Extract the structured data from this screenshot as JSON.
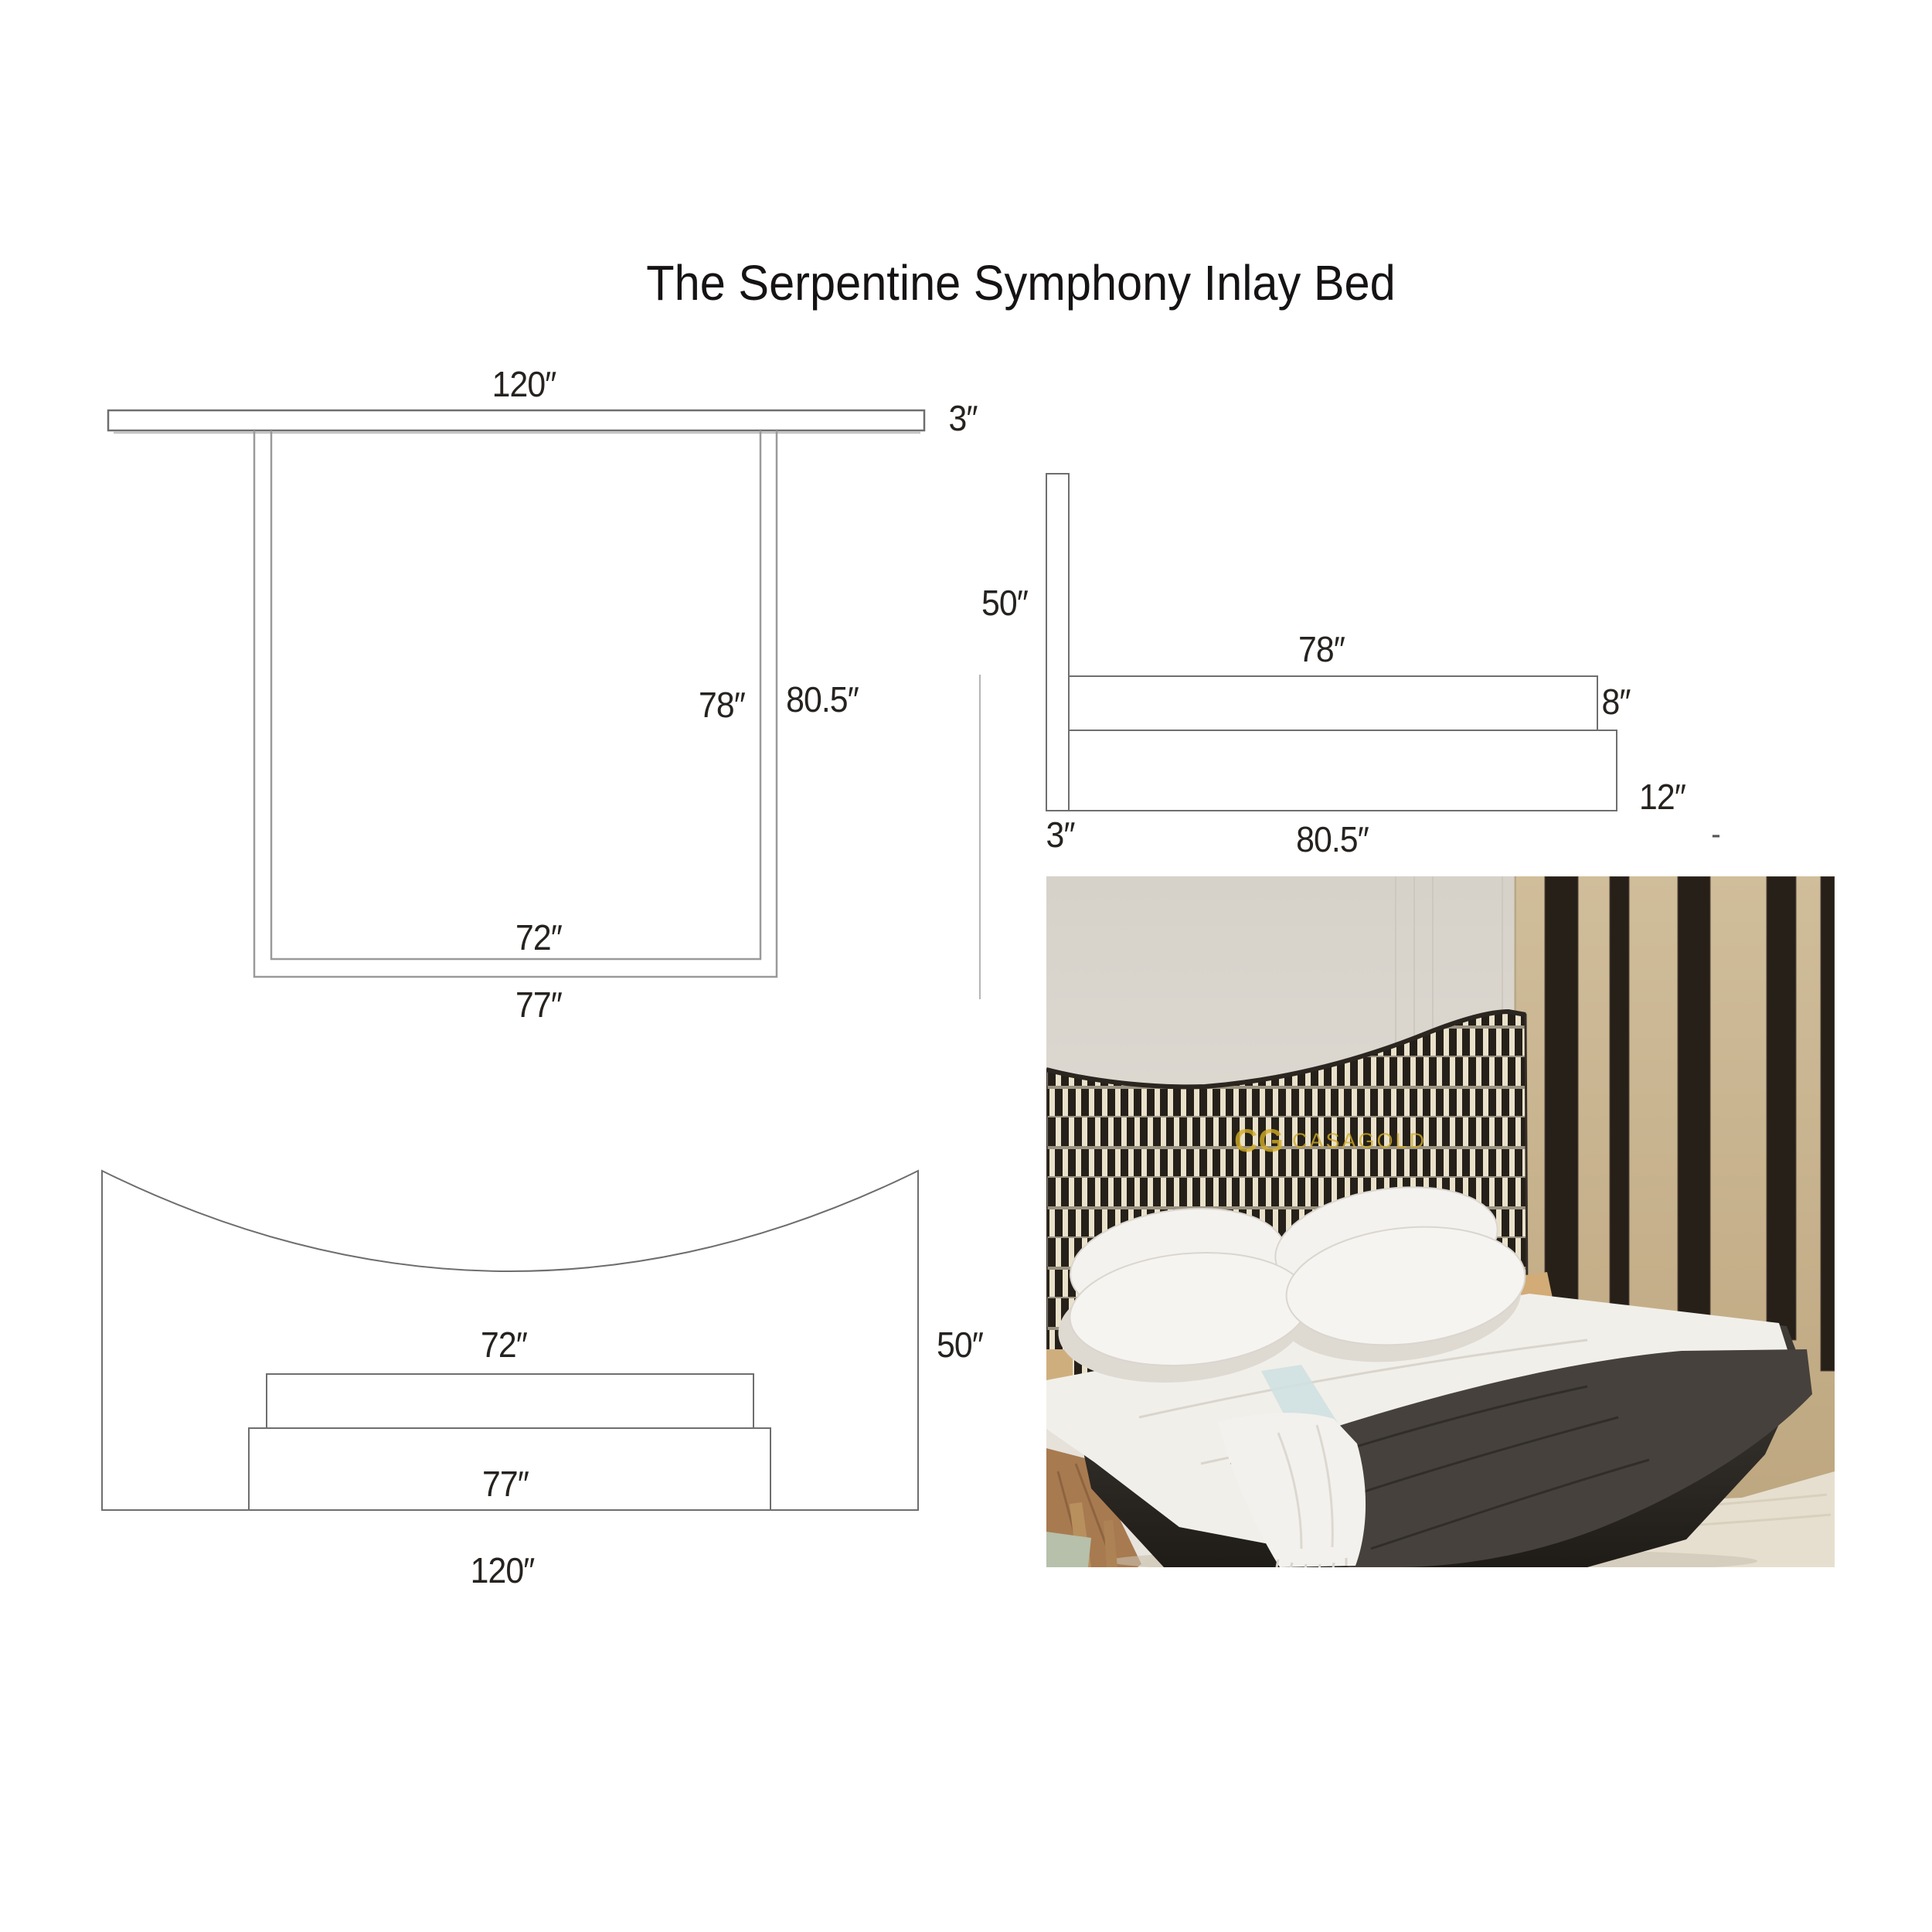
{
  "title": "The Serpentine Symphony Inlay Bed",
  "views": {
    "top": {
      "labels": {
        "headboard_width": "120″",
        "headboard_thickness": "3″",
        "mattress_length": "78″",
        "overall_length": "80.5″",
        "mattress_width": "72″",
        "base_width": "77″"
      }
    },
    "side": {
      "labels": {
        "headboard_height": "50″",
        "mattress_length": "78″",
        "mattress_thickness": "8″",
        "base_height": "12″",
        "headboard_thickness": "3″",
        "base_length": "80.5″",
        "stray_mark": "-"
      }
    },
    "front": {
      "labels": {
        "mattress_width": "72″",
        "base_width": "77″",
        "headboard_height": "50″",
        "headboard_width": "120″"
      }
    }
  },
  "photo": {
    "watermark_monogram": "CG",
    "watermark_brand": "CASAGOLD"
  },
  "colors": {
    "drawing_line": "#6e6e6e",
    "drawing_line_light": "#9a9a9a",
    "label_text": "#26221f",
    "watermark_gold": "#d2ac25",
    "headboard_black": "#252019",
    "headboard_bone": "#eae1cb",
    "wall_left_grey": "#e0dcd4",
    "wall_right_tan": "#c7b28c",
    "batten_dark": "#262019",
    "platform_dark": "#34302a",
    "bedding_white": "#f1efe9",
    "blanket_charcoal": "#46413c",
    "runner_blue": "#cfe0e1",
    "rug_ivory": "#e6dfcf",
    "floor_wood": "#a87a50"
  }
}
